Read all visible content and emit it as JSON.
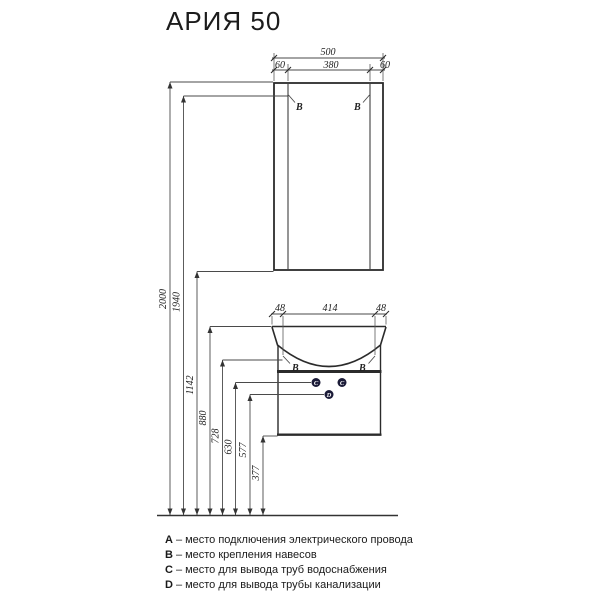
{
  "title": "АРИЯ 50",
  "drawing": {
    "mirror_dims": {
      "total": "500",
      "left": "60",
      "center": "380",
      "right": "60"
    },
    "vanity_dims": {
      "left": "48",
      "center": "414",
      "right": "48"
    },
    "height_dims": [
      "2000",
      "1940",
      "1142",
      "880",
      "728",
      "630",
      "577",
      "377"
    ],
    "markers": {
      "hanger": "B",
      "water": "C",
      "drain": "D"
    },
    "marker_fill": "#1b1b38"
  },
  "legend": {
    "separator": "–",
    "items": [
      {
        "key": "A",
        "label": "место подключения электрического провода"
      },
      {
        "key": "B",
        "label": "место крепления навесов"
      },
      {
        "key": "C",
        "label": "место для вывода труб водоснабжения"
      },
      {
        "key": "D",
        "label": "место для вывода трубы канализации"
      }
    ]
  }
}
